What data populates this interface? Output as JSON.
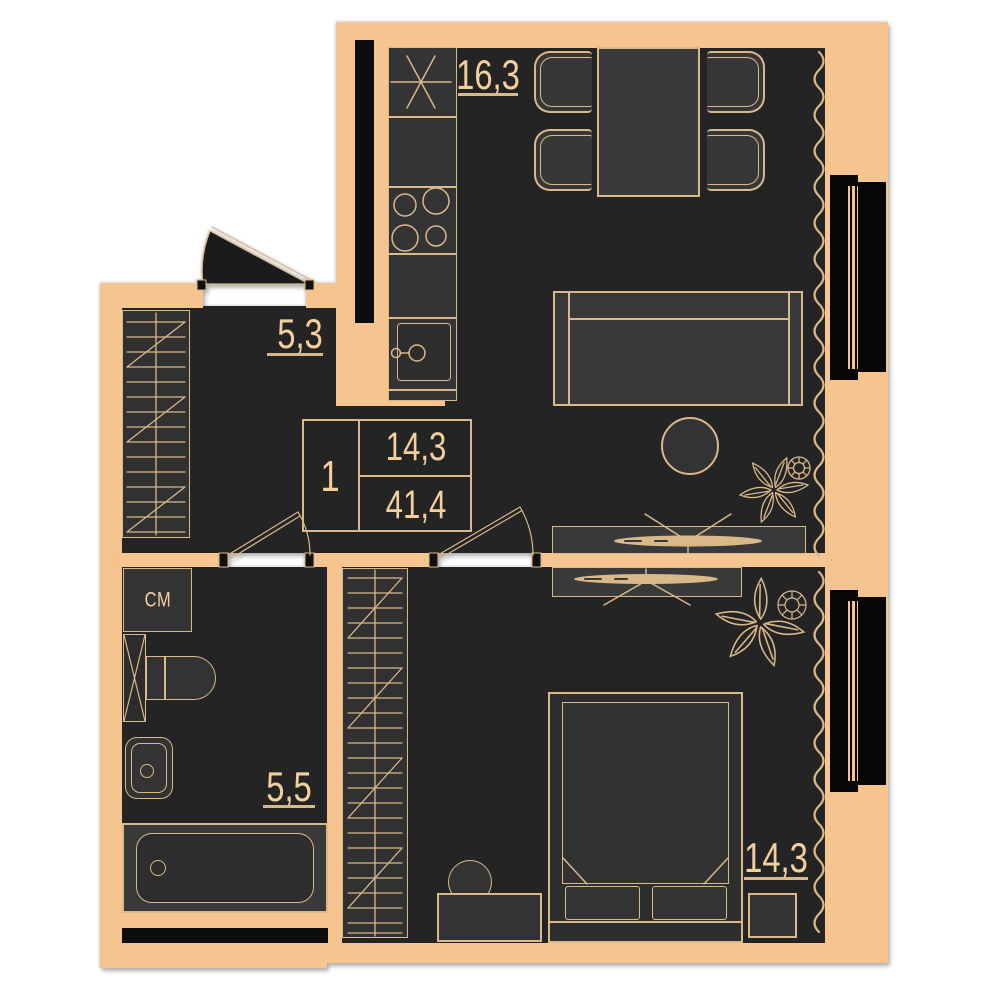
{
  "floor_plan": {
    "apartment_summary": {
      "rooms_count_label": "1",
      "living_area_value": "14,3",
      "total_area_value": "41,4"
    },
    "rooms": {
      "kitchen_living": {
        "area_label": "16,3"
      },
      "hallway": {
        "area_label": "5,3"
      },
      "bathroom": {
        "area_label": "5,5"
      },
      "bedroom": {
        "area_label": "14,3"
      }
    },
    "appliances": {
      "washing_machine_label": "СМ"
    },
    "symbols": {
      "cooker_hood": "six-spoke asterisk",
      "stove": "four burner circles",
      "wardrobe": "rail with hanger hatching",
      "curtain": "vertical wavy line",
      "door_swing": "quarter-arc with leaf",
      "tv": "flat ellipse with view lines",
      "plant": "flower doodle"
    },
    "colors": {
      "wall": "#f6c48f",
      "floor": "#242424",
      "furniture": "#343434",
      "outline": "#d9b88a",
      "text": "#f3cf9d",
      "window": "#060606",
      "background": "#ffffff"
    }
  }
}
